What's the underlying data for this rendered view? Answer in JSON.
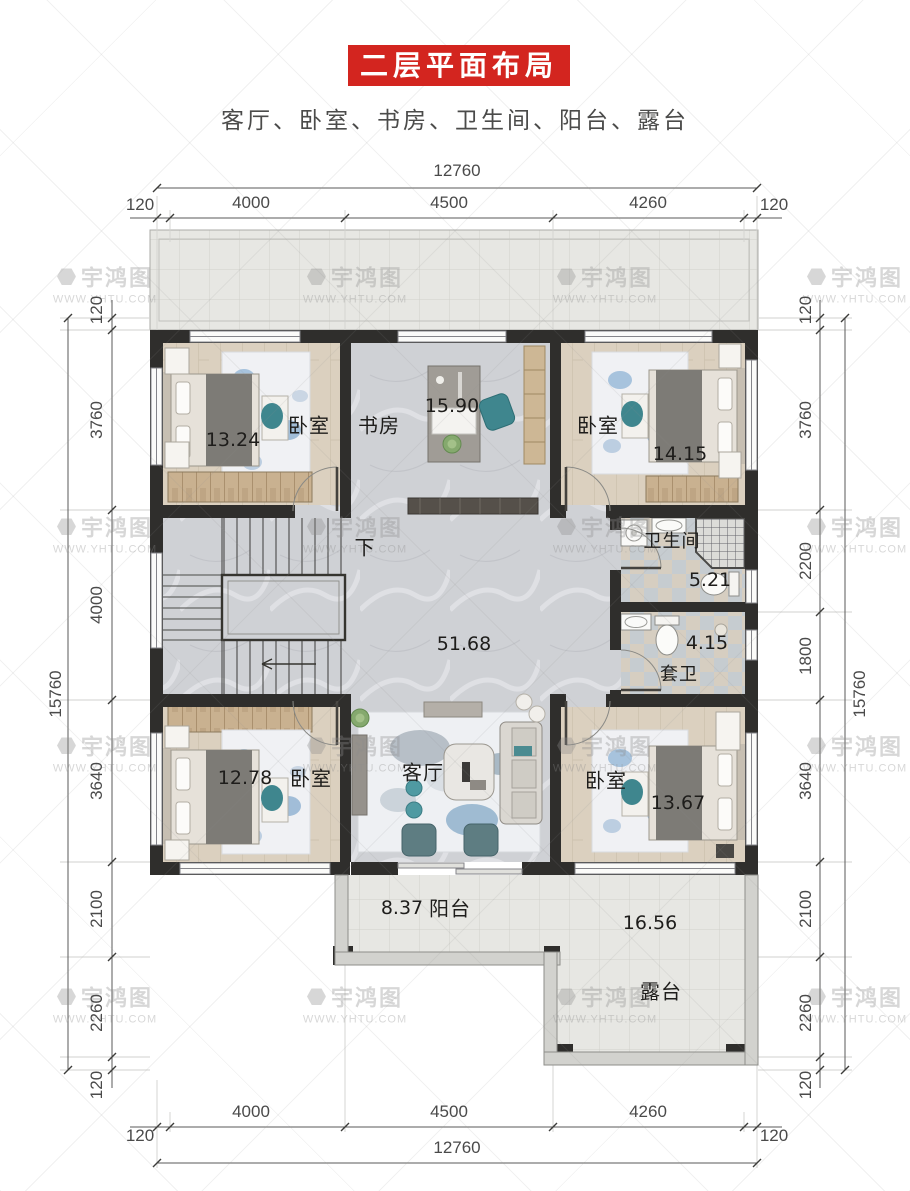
{
  "title": "二层平面布局图",
  "subtitle": "客厅、卧室、书房、卫生间、阳台、露台",
  "watermark": {
    "brand": "宇鸿图",
    "url": "WWW.YHTU.COM"
  },
  "dimensions": {
    "top": {
      "total": "12760",
      "segments": [
        "120",
        "4000",
        "4500",
        "4260",
        "120"
      ]
    },
    "bottom": {
      "total": "12760",
      "segments": [
        "120",
        "4000",
        "4500",
        "4260",
        "120"
      ]
    },
    "left": {
      "total": "15760",
      "segments": [
        "120",
        "3760",
        "4000",
        "3640",
        "2100",
        "2260",
        "120"
      ]
    },
    "right": {
      "total": "15760",
      "segments": [
        "120",
        "3760",
        "2200",
        "1800",
        "3640",
        "2100",
        "2260",
        "120"
      ]
    }
  },
  "rooms": {
    "bedroom_top_left": {
      "name": "卧室",
      "area": "13.24"
    },
    "study": {
      "name": "书房",
      "area": "15.90"
    },
    "bedroom_top_right": {
      "name": "卧室",
      "area": "14.15"
    },
    "bathroom": {
      "name": "卫生间",
      "area": "5.21"
    },
    "ensuite": {
      "name": "套卫",
      "area": "4.15"
    },
    "hall": {
      "area": "51.68",
      "stairs_label": "下"
    },
    "bedroom_bottom_left": {
      "name": "卧室",
      "area": "12.78"
    },
    "living": {
      "name": "客厅"
    },
    "bedroom_bottom_right": {
      "name": "卧室",
      "area": "13.67"
    },
    "balcony": {
      "name": "阳台",
      "area": "8.37"
    },
    "terrace": {
      "name": "露台",
      "area": "16.56"
    }
  }
}
